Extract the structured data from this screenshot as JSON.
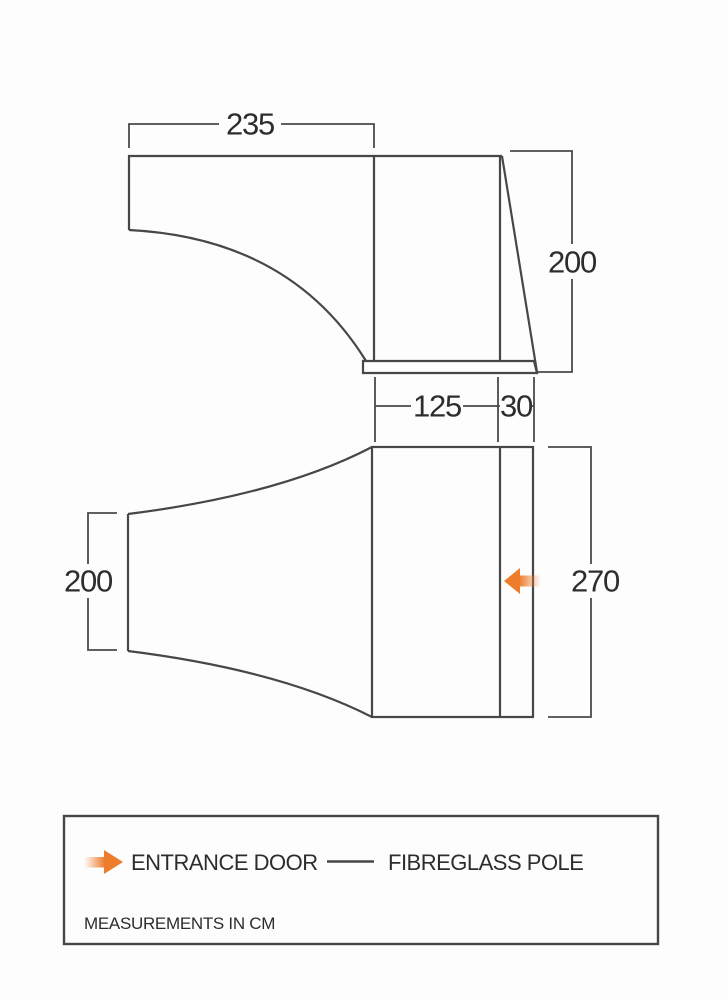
{
  "palette": {
    "line": "#474747",
    "text": "#2d2d2d",
    "accent_orange": "#ed7c2b",
    "background": "#fdfdfd"
  },
  "side_view": {
    "dim_canopy_width": "235",
    "dim_height": "200"
  },
  "plan_view": {
    "dim_inner_depth": "125",
    "dim_pole_offset": "30",
    "dim_tunnel_width": "200",
    "dim_overall_width": "270"
  },
  "legend": {
    "entrance_door_label": "ENTRANCE DOOR",
    "fibreglass_pole_label": "FIBREGLASS POLE",
    "note": "MEASUREMENTS IN CM"
  }
}
